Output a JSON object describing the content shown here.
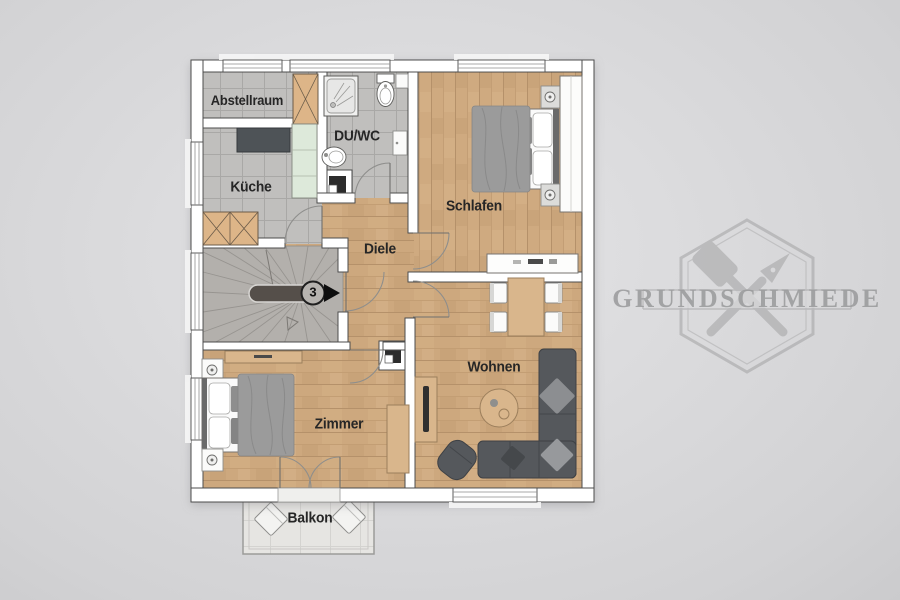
{
  "watermark": {
    "brand": "GRUNDSCHMIEDE",
    "color": "#9a9a9a"
  },
  "floorplan": {
    "rooms": [
      {
        "id": "abstellraum",
        "label": "Abstellraum"
      },
      {
        "id": "kueche",
        "label": "Küche"
      },
      {
        "id": "du-wc",
        "label": "DU/WC"
      },
      {
        "id": "schlafen",
        "label": "Schlafen"
      },
      {
        "id": "diele",
        "label": "Diele"
      },
      {
        "id": "zimmer",
        "label": "Zimmer"
      },
      {
        "id": "wohnen",
        "label": "Wohnen"
      },
      {
        "id": "balkon",
        "label": "Balkon"
      }
    ],
    "stairs": {
      "apartment_number": "3"
    }
  },
  "colors": {
    "background": "#d8d8da",
    "wall": "#ffffff",
    "wall_outline": "#4c4c4c",
    "wood_floor": "#cda87e",
    "tile_floor": "#c0bfbd",
    "stairs_floor": "#b3b0ac",
    "furniture_wood": "#d9b68c",
    "sofa_gray": "#55585c",
    "blanket_gray": "#9b9b9b",
    "kitchen_counter": "#4e5357",
    "kitchen_tall_unit": "#dde9da"
  },
  "icons": {
    "stairs-up-arrow": "black triangle pointing right",
    "chimney": "black square in white square flue symbol",
    "door-swing": "quarter-circle arc",
    "window": "double-line wall opening"
  }
}
